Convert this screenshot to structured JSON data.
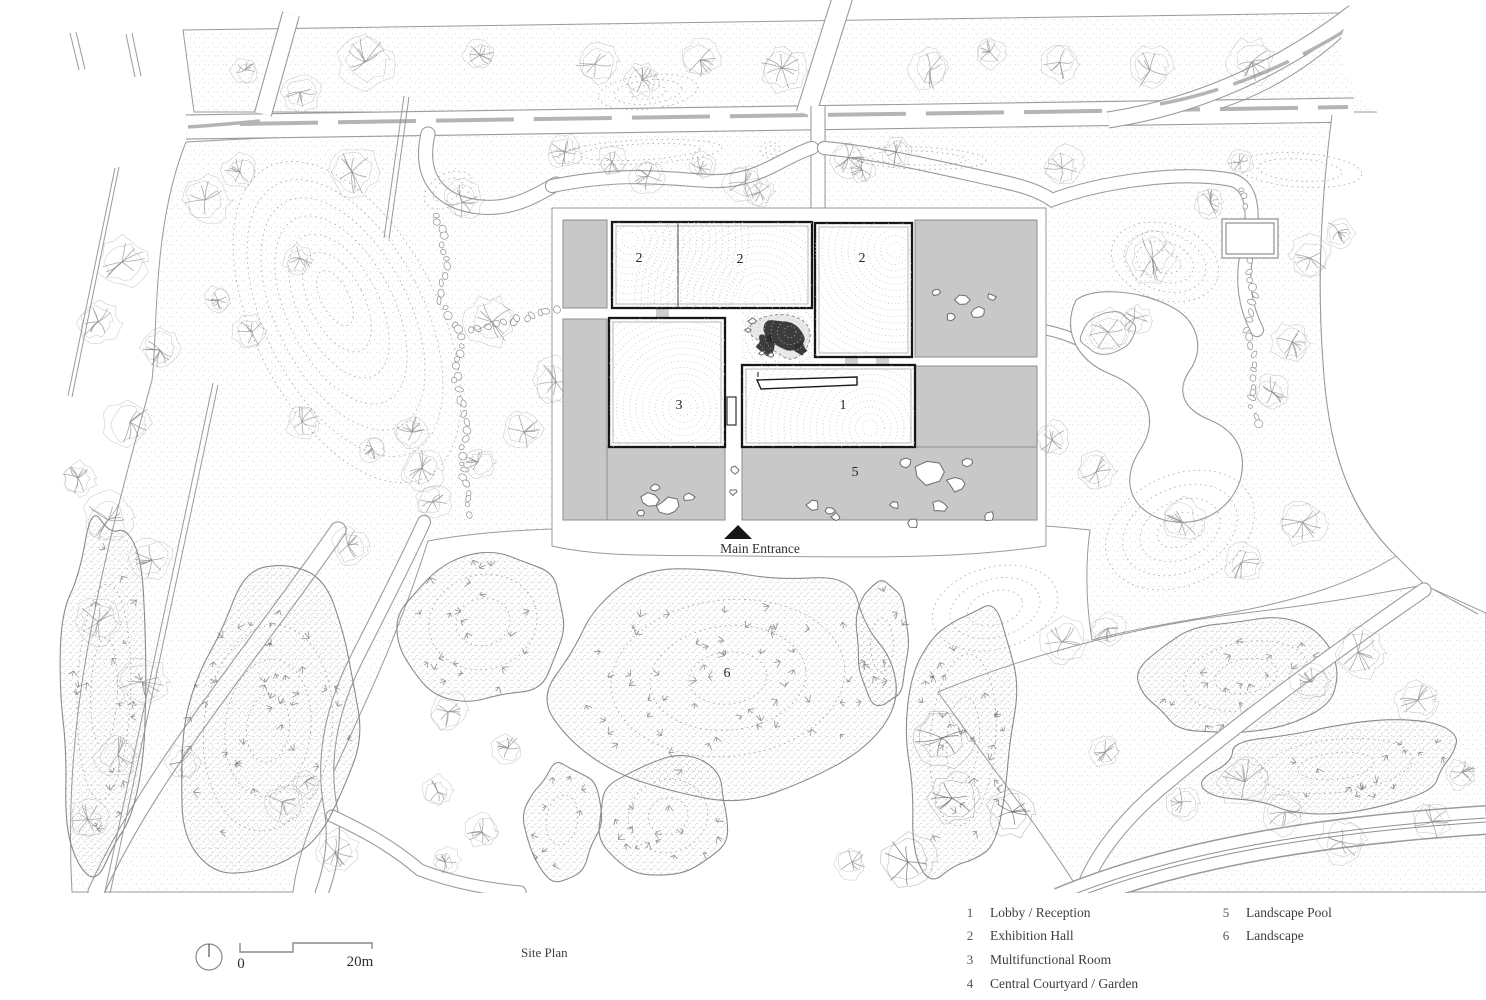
{
  "title": "Site Plan",
  "plan_labels": {
    "room1": "1",
    "room2a": "2",
    "room2b": "2",
    "room2c": "2",
    "room3": "3",
    "courtyard": "4",
    "pool": "5",
    "landscape": "6",
    "main_entrance": "Main Entrance"
  },
  "scale_bar": {
    "start": "0",
    "end": "20m"
  },
  "legend": {
    "column1": [
      {
        "num": "1",
        "label": "Lobby / Reception"
      },
      {
        "num": "2",
        "label": "Exhibition Hall"
      },
      {
        "num": "3",
        "label": "Multifunctional Room"
      },
      {
        "num": "4",
        "label": "Central Courtyard / Garden"
      }
    ],
    "column2": [
      {
        "num": "5",
        "label": "Landscape Pool"
      },
      {
        "num": "6",
        "label": "Landscape"
      }
    ]
  },
  "colors": {
    "paving": "#c8c8c8",
    "ink": "#161616",
    "edge": "#9b9b9b",
    "median_dash": "#b4b4b4",
    "stipple": "#8d8d8d",
    "courtyard_canopy": "#2e2e2e"
  }
}
